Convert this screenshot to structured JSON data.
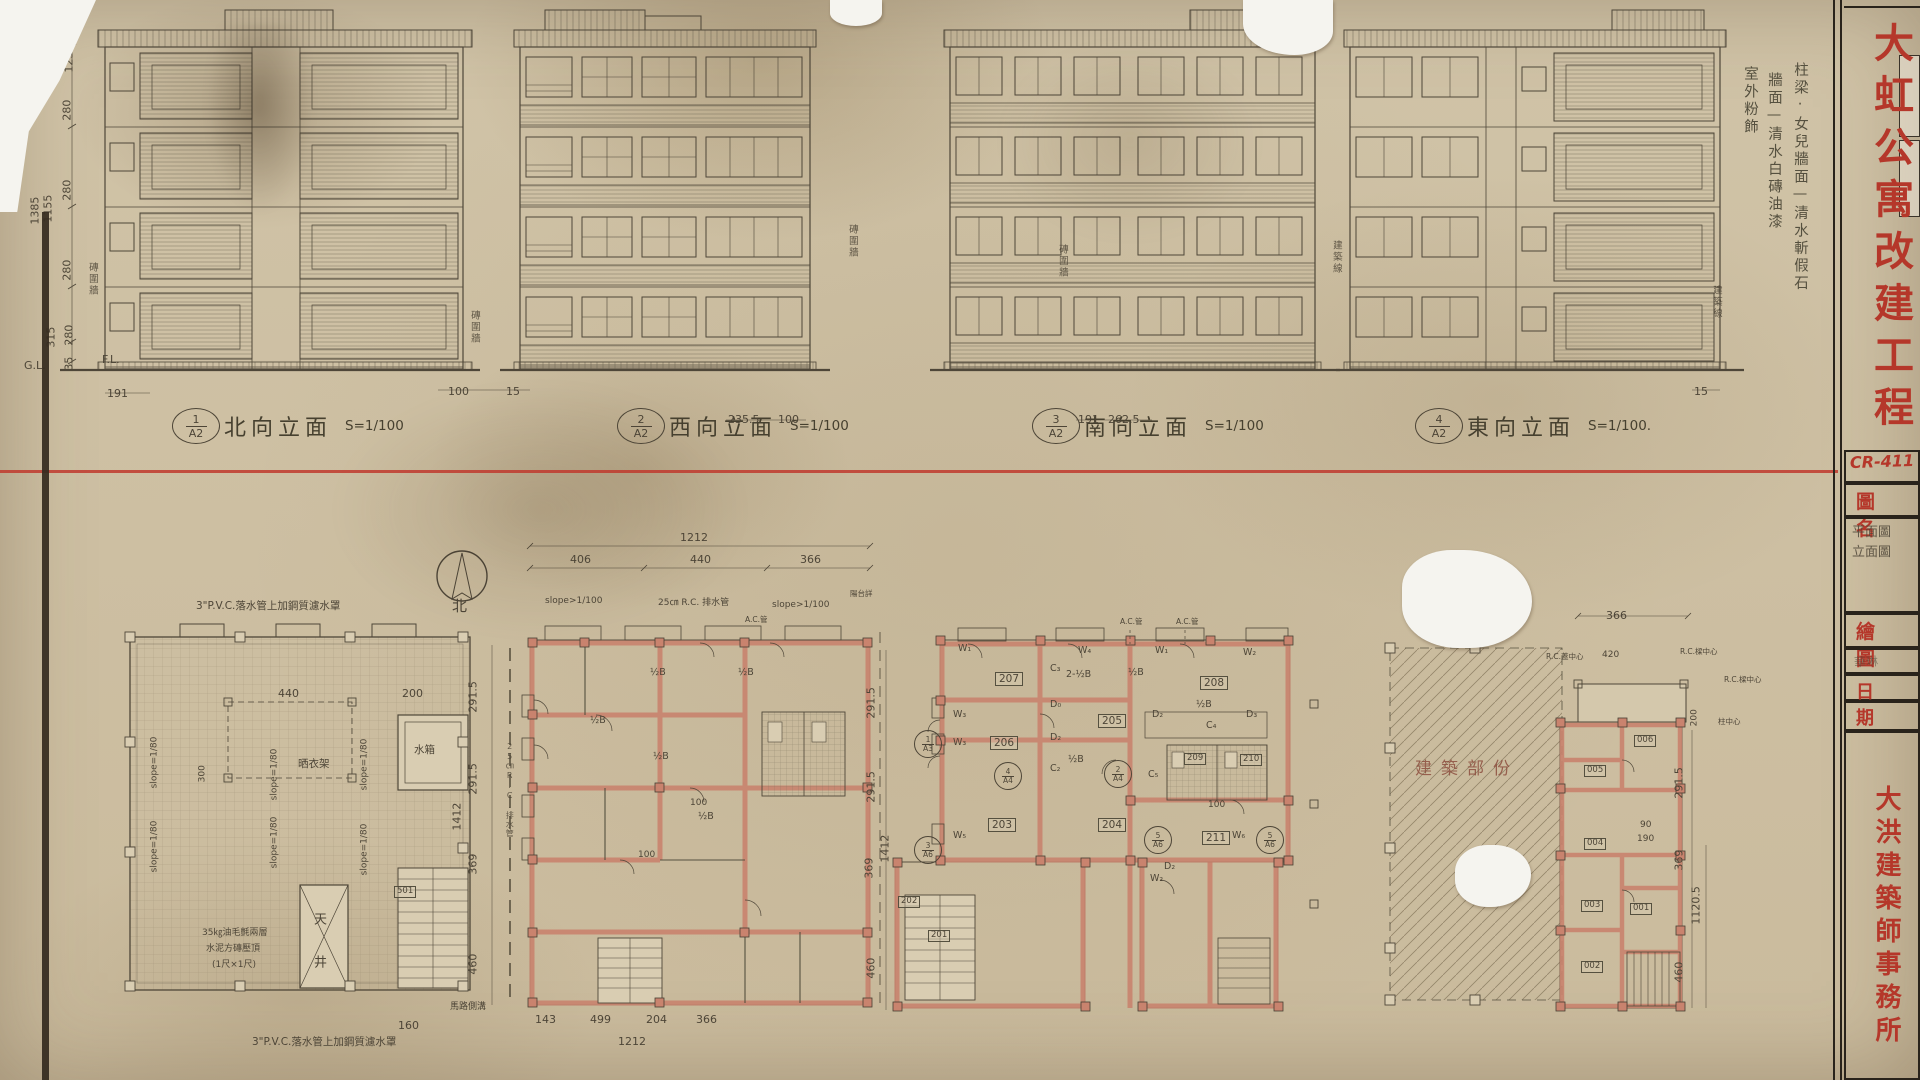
{
  "sheet": {
    "drawing_no": "CR-411",
    "project_title": "大虹公寓改建工程",
    "firm_name": "大洪建築師事務所",
    "field_drawing_name": "圖名",
    "drawing_name_lines": [
      "平面圖",
      "立面圖"
    ],
    "field_drawn_by": "繪圖",
    "drawn_by_signature": "華琳",
    "field_date": "日期"
  },
  "elevations": [
    {
      "num": "1",
      "sheet": "A2",
      "name": "北向立面",
      "scale": "S=1/100"
    },
    {
      "num": "2",
      "sheet": "A2",
      "name": "西向立面",
      "scale": "S=1/100"
    },
    {
      "num": "3",
      "sheet": "A2",
      "name": "南向立面",
      "scale": "S=1/100"
    },
    {
      "num": "4",
      "sheet": "A2",
      "name": "東向立面",
      "scale": "S=1/100."
    }
  ],
  "exterior_finish_notes": [
    "柱梁‧女兒牆面—清水斬假石",
    "牆面—清水白磚油漆",
    "室外粉飾"
  ],
  "north_label": "北",
  "colors": {
    "stamp_red": "#b5372a",
    "line_red": "#bf3a2e",
    "wall_pink": "#c9836e",
    "pencil": "#4d4537",
    "paper": "#d0c3a7"
  },
  "annotations": [
    {
      "t": "230",
      "x": 58,
      "y": 32,
      "c": "dimv"
    },
    {
      "t": "107",
      "x": 76,
      "y": 30,
      "c": "dimv"
    },
    {
      "t": "123",
      "x": 76,
      "y": 60,
      "c": "dimv"
    },
    {
      "t": "280",
      "x": 74,
      "y": 108,
      "c": "dimv"
    },
    {
      "t": "280",
      "x": 74,
      "y": 188,
      "c": "dimv"
    },
    {
      "t": "280",
      "x": 74,
      "y": 268,
      "c": "dimv"
    },
    {
      "t": "315",
      "x": 58,
      "y": 335,
      "c": "dimv"
    },
    {
      "t": "280",
      "x": 76,
      "y": 333,
      "c": "dimv"
    },
    {
      "t": "35",
      "x": 76,
      "y": 358,
      "c": "dimv"
    },
    {
      "t": "1385",
      "x": 42,
      "y": 212,
      "c": "dimv"
    },
    {
      "t": "1155",
      "x": 55,
      "y": 210,
      "c": "dimv"
    },
    {
      "t": "G.L.",
      "x": 24,
      "y": 360,
      "c": "dim"
    },
    {
      "t": "F.L.",
      "x": 102,
      "y": 354,
      "c": "dim"
    },
    {
      "t": "191",
      "x": 107,
      "y": 388,
      "c": "dim"
    },
    {
      "t": "磚圍牆",
      "x": 86,
      "y": 262,
      "c": "notev"
    },
    {
      "t": "100",
      "x": 448,
      "y": 386,
      "c": "dim"
    },
    {
      "t": "15",
      "x": 506,
      "y": 386,
      "c": "dim"
    },
    {
      "t": "磚圍牆",
      "x": 468,
      "y": 310,
      "c": "notev"
    },
    {
      "t": "磚圍牆",
      "x": 846,
      "y": 224,
      "c": "notev"
    },
    {
      "t": "235.5",
      "x": 728,
      "y": 414,
      "c": "dim"
    },
    {
      "t": "100",
      "x": 778,
      "y": 414,
      "c": "dim"
    },
    {
      "t": "磚圍牆",
      "x": 1056,
      "y": 244,
      "c": "notev"
    },
    {
      "t": "191",
      "x": 1078,
      "y": 414,
      "c": "dim"
    },
    {
      "t": "262.5",
      "x": 1108,
      "y": 414,
      "c": "dim"
    },
    {
      "t": "建築線",
      "x": 1330,
      "y": 240,
      "c": "notev"
    },
    {
      "t": "建築線",
      "x": 1710,
      "y": 285,
      "c": "notev"
    },
    {
      "t": "15",
      "x": 1694,
      "y": 386,
      "c": "dim"
    },
    {
      "t": "3\"P.V.C.落水管上加鋼質濾水罩",
      "x": 196,
      "y": 600,
      "c": "note"
    },
    {
      "t": "3\"P.V.C.落水管上加鋼質濾水罩",
      "x": 252,
      "y": 1036,
      "c": "note"
    },
    {
      "t": "slope=1/80",
      "x": 160,
      "y": 778,
      "c": "dimv-s"
    },
    {
      "t": "slope=1/80",
      "x": 280,
      "y": 790,
      "c": "dimv-s"
    },
    {
      "t": "slope=1/80",
      "x": 370,
      "y": 780,
      "c": "dimv-s"
    },
    {
      "t": "slope=1/80",
      "x": 160,
      "y": 862,
      "c": "dimv-s"
    },
    {
      "t": "slope=1/80",
      "x": 280,
      "y": 858,
      "c": "dimv-s"
    },
    {
      "t": "slope=1/80",
      "x": 370,
      "y": 865,
      "c": "dimv-s"
    },
    {
      "t": "440",
      "x": 278,
      "y": 688,
      "c": "dim"
    },
    {
      "t": "300",
      "x": 208,
      "y": 772,
      "c": "dimv-s"
    },
    {
      "t": "200",
      "x": 402,
      "y": 688,
      "c": "dim"
    },
    {
      "t": "晒衣架",
      "x": 298,
      "y": 758,
      "c": "note"
    },
    {
      "t": "水箱",
      "x": 414,
      "y": 744,
      "c": "note"
    },
    {
      "t": "天井",
      "x": 310,
      "y": 912,
      "c": "notev2"
    },
    {
      "t": "35㎏油毛氈兩層",
      "x": 202,
      "y": 928,
      "c": "note-s"
    },
    {
      "t": "水泥方磚壓頂",
      "x": 206,
      "y": 944,
      "c": "note-s"
    },
    {
      "t": "(1尺×1尺)",
      "x": 212,
      "y": 960,
      "c": "note-s"
    },
    {
      "t": "501",
      "x": 394,
      "y": 886,
      "c": "room-s"
    },
    {
      "t": "160",
      "x": 398,
      "y": 1020,
      "c": "dim"
    },
    {
      "t": "北",
      "x": 452,
      "y": 598,
      "c": "north"
    },
    {
      "t": "1212",
      "x": 680,
      "y": 532,
      "c": "dim"
    },
    {
      "t": "406",
      "x": 570,
      "y": 554,
      "c": "dim"
    },
    {
      "t": "440",
      "x": 690,
      "y": 554,
      "c": "dim"
    },
    {
      "t": "366",
      "x": 800,
      "y": 554,
      "c": "dim"
    },
    {
      "t": "slope>1/100",
      "x": 545,
      "y": 596,
      "c": "note-s"
    },
    {
      "t": "25㎝ R.C. 排水管",
      "x": 658,
      "y": 598,
      "c": "note-s"
    },
    {
      "t": "slope>1/100",
      "x": 772,
      "y": 600,
      "c": "note-s"
    },
    {
      "t": "陽台詳",
      "x": 850,
      "y": 590,
      "c": "note-xs"
    },
    {
      "t": "A.C.管",
      "x": 745,
      "y": 616,
      "c": "note-xs"
    },
    {
      "t": "291.5",
      "x": 480,
      "y": 700,
      "c": "dimv"
    },
    {
      "t": "291.5",
      "x": 480,
      "y": 782,
      "c": "dimv"
    },
    {
      "t": "369",
      "x": 480,
      "y": 862,
      "c": "dimv"
    },
    {
      "t": "460",
      "x": 480,
      "y": 962,
      "c": "dimv"
    },
    {
      "t": "1412",
      "x": 464,
      "y": 818,
      "c": "dimv"
    },
    {
      "t": "25㎝R.C.排水管",
      "x": 505,
      "y": 742,
      "c": "notev-s"
    },
    {
      "t": "½B",
      "x": 590,
      "y": 716,
      "c": "mark"
    },
    {
      "t": "½B",
      "x": 650,
      "y": 668,
      "c": "mark"
    },
    {
      "t": "½B",
      "x": 653,
      "y": 752,
      "c": "mark"
    },
    {
      "t": "½B",
      "x": 738,
      "y": 668,
      "c": "mark"
    },
    {
      "t": "½B",
      "x": 698,
      "y": 812,
      "c": "mark"
    },
    {
      "t": "100",
      "x": 690,
      "y": 798,
      "c": "dim-s"
    },
    {
      "t": "100",
      "x": 638,
      "y": 850,
      "c": "dim-s"
    },
    {
      "t": "143",
      "x": 535,
      "y": 1014,
      "c": "dim"
    },
    {
      "t": "499",
      "x": 590,
      "y": 1014,
      "c": "dim"
    },
    {
      "t": "204",
      "x": 646,
      "y": 1014,
      "c": "dim"
    },
    {
      "t": "366",
      "x": 696,
      "y": 1014,
      "c": "dim"
    },
    {
      "t": "1212",
      "x": 618,
      "y": 1036,
      "c": "dim"
    },
    {
      "t": "馬路側溝",
      "x": 450,
      "y": 1002,
      "c": "note-s"
    },
    {
      "t": "291.5",
      "x": 878,
      "y": 706,
      "c": "dimv"
    },
    {
      "t": "291.5",
      "x": 878,
      "y": 790,
      "c": "dimv"
    },
    {
      "t": "369",
      "x": 876,
      "y": 866,
      "c": "dimv"
    },
    {
      "t": "1412",
      "x": 892,
      "y": 850,
      "c": "dimv"
    },
    {
      "t": "460",
      "x": 878,
      "y": 966,
      "c": "dimv"
    },
    {
      "t": "A.C.管",
      "x": 1120,
      "y": 618,
      "c": "note-xs"
    },
    {
      "t": "A.C.管",
      "x": 1176,
      "y": 618,
      "c": "note-xs"
    },
    {
      "t": "207",
      "x": 995,
      "y": 672,
      "c": "room"
    },
    {
      "t": "206",
      "x": 990,
      "y": 736,
      "c": "room"
    },
    {
      "t": "205",
      "x": 1098,
      "y": 714,
      "c": "room"
    },
    {
      "t": "208",
      "x": 1200,
      "y": 676,
      "c": "room"
    },
    {
      "t": "203",
      "x": 988,
      "y": 818,
      "c": "room"
    },
    {
      "t": "204",
      "x": 1098,
      "y": 818,
      "c": "room"
    },
    {
      "t": "211",
      "x": 1202,
      "y": 831,
      "c": "room"
    },
    {
      "t": "209",
      "x": 1184,
      "y": 753,
      "c": "room-s"
    },
    {
      "t": "210",
      "x": 1240,
      "y": 754,
      "c": "room-s"
    },
    {
      "t": "202",
      "x": 898,
      "y": 896,
      "c": "room-s"
    },
    {
      "t": "201",
      "x": 928,
      "y": 930,
      "c": "room-s"
    },
    {
      "t": "W₁",
      "x": 958,
      "y": 644,
      "c": "mark"
    },
    {
      "t": "W₄",
      "x": 1078,
      "y": 646,
      "c": "mark"
    },
    {
      "t": "W₁",
      "x": 1155,
      "y": 646,
      "c": "mark"
    },
    {
      "t": "W₂",
      "x": 1243,
      "y": 648,
      "c": "mark"
    },
    {
      "t": "W₃",
      "x": 953,
      "y": 710,
      "c": "mark"
    },
    {
      "t": "W₃",
      "x": 953,
      "y": 738,
      "c": "mark"
    },
    {
      "t": "W₅",
      "x": 953,
      "y": 831,
      "c": "mark"
    },
    {
      "t": "W₆",
      "x": 1232,
      "y": 831,
      "c": "mark"
    },
    {
      "t": "C₃",
      "x": 1050,
      "y": 664,
      "c": "mark"
    },
    {
      "t": "2-½B",
      "x": 1066,
      "y": 670,
      "c": "mark"
    },
    {
      "t": "C₄",
      "x": 1206,
      "y": 721,
      "c": "mark"
    },
    {
      "t": "C₂",
      "x": 1050,
      "y": 764,
      "c": "mark"
    },
    {
      "t": "C₅",
      "x": 1148,
      "y": 770,
      "c": "mark"
    },
    {
      "t": "D₀",
      "x": 1050,
      "y": 700,
      "c": "mark"
    },
    {
      "t": "D₂",
      "x": 1050,
      "y": 733,
      "c": "mark"
    },
    {
      "t": "D₂",
      "x": 1152,
      "y": 710,
      "c": "mark"
    },
    {
      "t": "D₃",
      "x": 1246,
      "y": 710,
      "c": "mark"
    },
    {
      "t": "D₂",
      "x": 1164,
      "y": 862,
      "c": "mark"
    },
    {
      "t": "W₂",
      "x": 1150,
      "y": 874,
      "c": "mark"
    },
    {
      "t": "½B",
      "x": 1128,
      "y": 668,
      "c": "mark"
    },
    {
      "t": "½B",
      "x": 1196,
      "y": 700,
      "c": "mark"
    },
    {
      "t": "½B",
      "x": 1068,
      "y": 755,
      "c": "mark"
    },
    {
      "t": "100",
      "x": 1208,
      "y": 800,
      "c": "dim-s"
    },
    {
      "t": "1/A3",
      "x": 914,
      "y": 730,
      "c": "ref"
    },
    {
      "t": "3/A6",
      "x": 914,
      "y": 836,
      "c": "ref"
    },
    {
      "t": "2/A4",
      "x": 1104,
      "y": 760,
      "c": "ref"
    },
    {
      "t": "5/A6",
      "x": 1144,
      "y": 826,
      "c": "ref"
    },
    {
      "t": "5/A6",
      "x": 1256,
      "y": 826,
      "c": "ref"
    },
    {
      "t": "4/A4",
      "x": 994,
      "y": 762,
      "c": "ref"
    },
    {
      "t": "建築部份",
      "x": 1415,
      "y": 760,
      "c": "bigpencil"
    },
    {
      "t": "366",
      "x": 1606,
      "y": 610,
      "c": "dim"
    },
    {
      "t": "R.C.蓋中心",
      "x": 1546,
      "y": 653,
      "c": "note-xs"
    },
    {
      "t": "420",
      "x": 1602,
      "y": 650,
      "c": "dim-s"
    },
    {
      "t": "R.C.樑中心",
      "x": 1680,
      "y": 648,
      "c": "note-xs"
    },
    {
      "t": "R.C.樑中心",
      "x": 1724,
      "y": 676,
      "c": "note-xs"
    },
    {
      "t": "200",
      "x": 1700,
      "y": 716,
      "c": "dimv-s"
    },
    {
      "t": "柱中心",
      "x": 1718,
      "y": 718,
      "c": "note-xs"
    },
    {
      "t": "006",
      "x": 1634,
      "y": 735,
      "c": "room-s"
    },
    {
      "t": "005",
      "x": 1584,
      "y": 765,
      "c": "room-s"
    },
    {
      "t": "004",
      "x": 1584,
      "y": 838,
      "c": "room-s"
    },
    {
      "t": "003",
      "x": 1581,
      "y": 900,
      "c": "room-s"
    },
    {
      "t": "001",
      "x": 1630,
      "y": 903,
      "c": "room-s"
    },
    {
      "t": "002",
      "x": 1581,
      "y": 961,
      "c": "room-s"
    },
    {
      "t": "90",
      "x": 1640,
      "y": 820,
      "c": "dim-s"
    },
    {
      "t": "190",
      "x": 1637,
      "y": 834,
      "c": "dim-s"
    },
    {
      "t": "291.5",
      "x": 1686,
      "y": 786,
      "c": "dimv"
    },
    {
      "t": "369",
      "x": 1686,
      "y": 858,
      "c": "dimv"
    },
    {
      "t": "1120.5",
      "x": 1703,
      "y": 912,
      "c": "dimv"
    },
    {
      "t": "460",
      "x": 1686,
      "y": 970,
      "c": "dimv"
    }
  ]
}
